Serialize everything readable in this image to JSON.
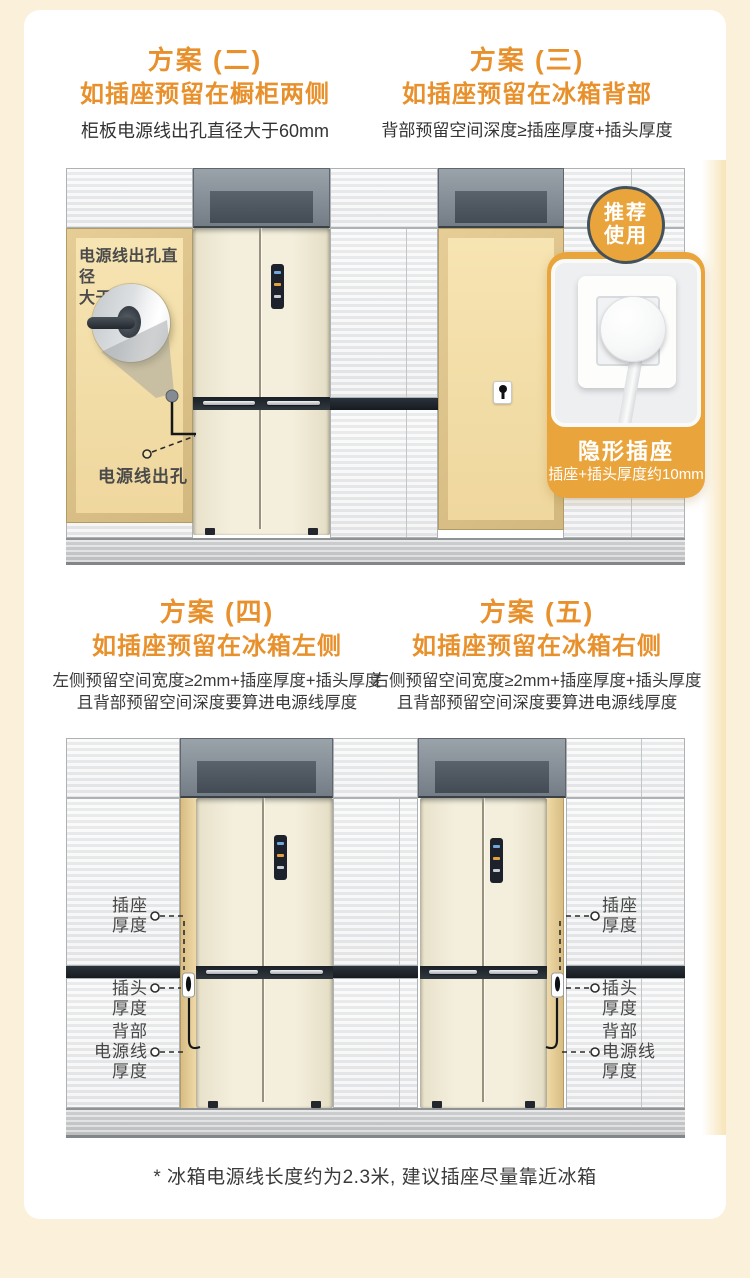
{
  "page": {
    "background": "#FBF0D9",
    "card_bg": "#FFFFFF",
    "footnote": "* 冰箱电源线长度约为2.3米, 建议插座尽量靠近冰箱"
  },
  "colors": {
    "heading_orange": "#E8912C",
    "callout_orange": "#E9A43B",
    "recess_tan": "#F3DFA9",
    "counter_dark": "#20262C",
    "fridge_cream": "#F1ECD8",
    "wall_gray": "#F0F1F2"
  },
  "plans": {
    "plan2": {
      "label": "方案 (二)",
      "title": "如插座预留在橱柜两侧",
      "desc": "柜板电源线出孔直径大于60mm"
    },
    "plan3": {
      "label": "方案 (三)",
      "title": "如插座预留在冰箱背部",
      "desc": "背部预留空间深度≥插座厚度+插头厚度"
    },
    "plan4": {
      "label": "方案 (四)",
      "title": "如插座预留在冰箱左侧",
      "desc1": "左侧预留空间宽度≥2mm+插座厚度+插头厚度",
      "desc2": "且背部预留空间深度要算进电源线厚度"
    },
    "plan5": {
      "label": "方案 (五)",
      "title": "如插座预留在冰箱右侧",
      "desc1": "右侧预留空间宽度≥2mm+插座厚度+插头厚度",
      "desc2": "且背部预留空间深度要算进电源线厚度"
    }
  },
  "scene1": {
    "hole_note1": "电源线出孔直径",
    "hole_note2": "大于60mm",
    "hole_label": "电源线出孔"
  },
  "callout": {
    "badge1": "推荐",
    "badge2": "使用",
    "title": "隐形插座",
    "subtitle": "插座+插头厚度约10mm"
  },
  "scene2": {
    "socket_label": [
      "插座",
      "厚度"
    ],
    "plug_label": [
      "插头",
      "厚度"
    ],
    "cord_label": [
      "背部",
      "电源线",
      "厚度"
    ]
  }
}
